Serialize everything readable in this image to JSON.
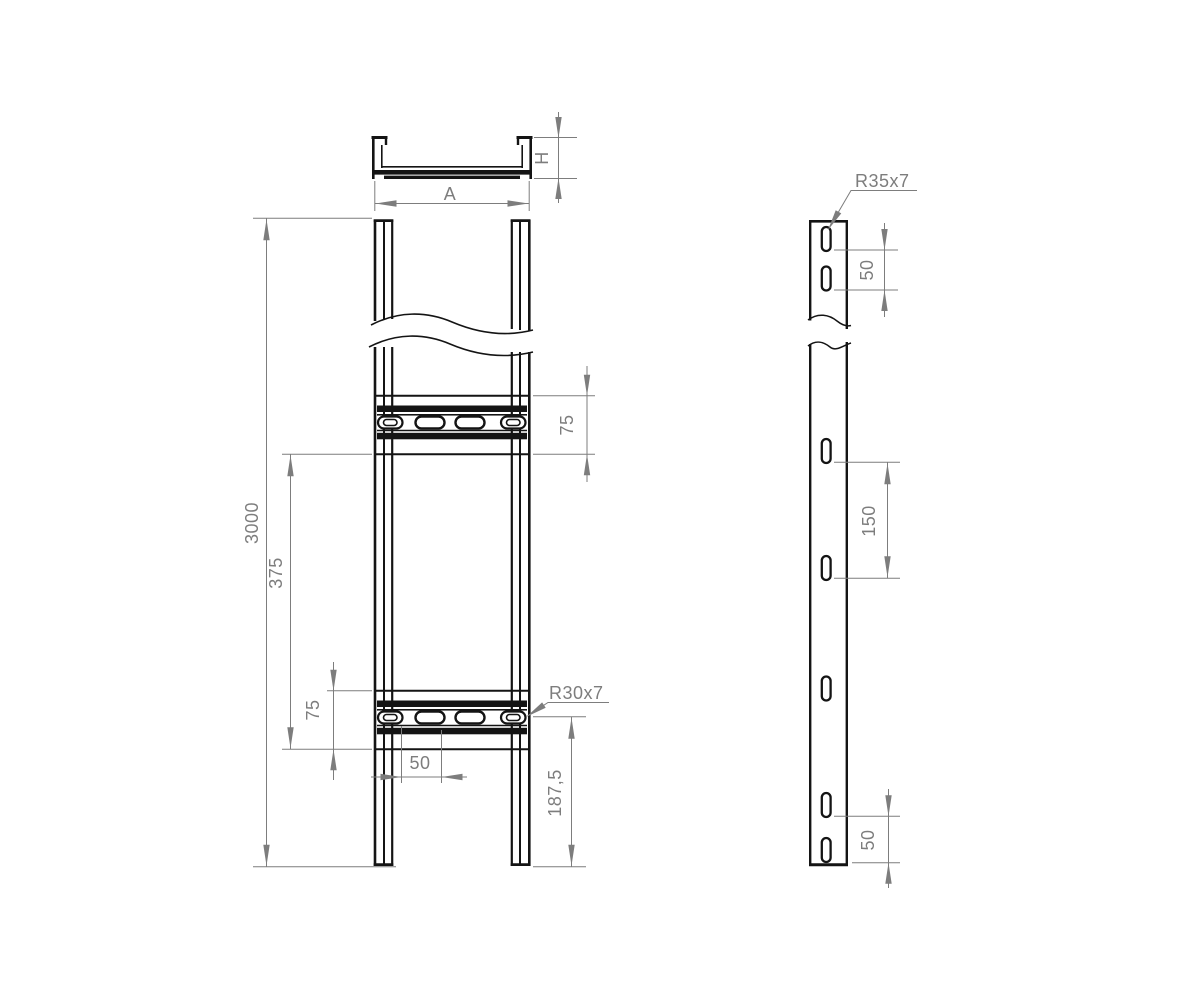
{
  "page": {
    "background": "#ffffff"
  },
  "colors": {
    "geometry": "#141414",
    "dimensions": "#7d7d7d"
  },
  "cross_section_view": {
    "width_dim": "A",
    "height_dim": "H"
  },
  "front_view": {
    "overall_length_dim": "3000",
    "rung_pitch_dim": "375",
    "upper_rung_height_dim": "75",
    "lower_rung_height_dim": "75",
    "slot_pitch_dim": "50",
    "end_distance_dim": "187,5",
    "slot_callout": "R30x7"
  },
  "side_view": {
    "slot_callout": "R35x7",
    "top_slot_pitch_dim": "50",
    "mid_slot_pitch_dim": "150",
    "bottom_slot_pitch_dim": "50"
  }
}
